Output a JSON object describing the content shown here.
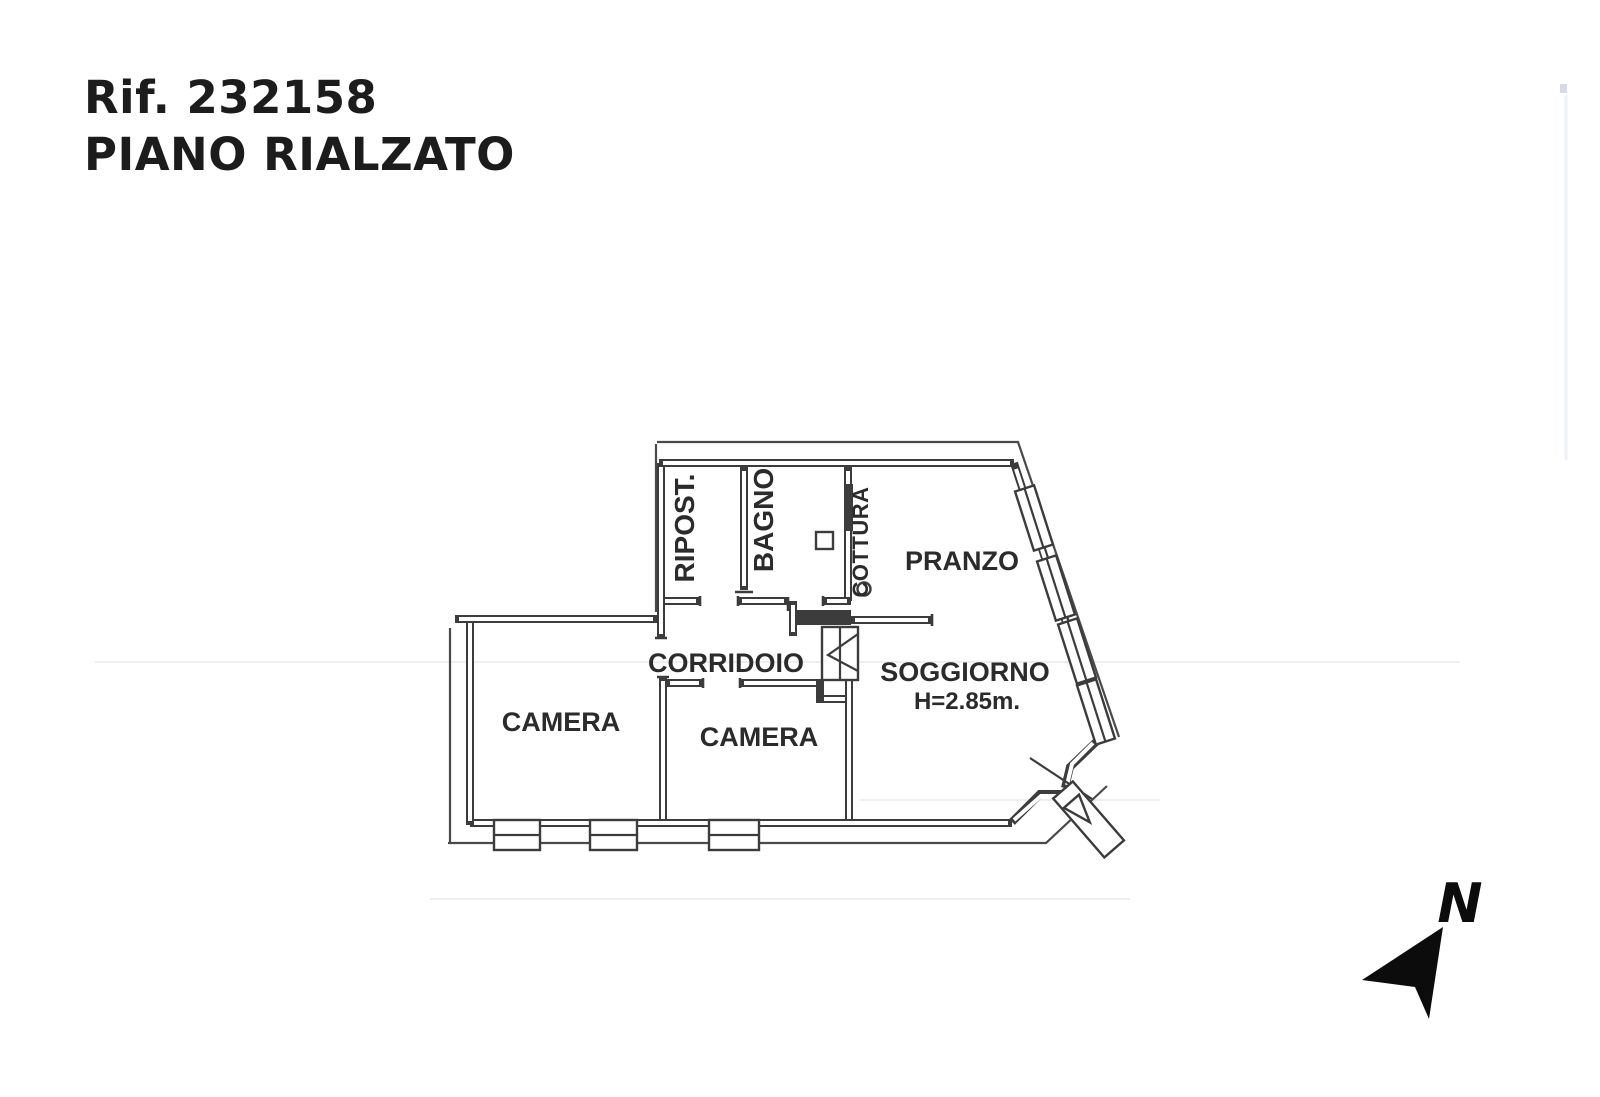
{
  "header": {
    "reference": "Rif. 232158",
    "floor": "PIANO RIALZATO"
  },
  "floorplan": {
    "rooms": {
      "ripost": "RIPOST.",
      "bagno": "BAGNO",
      "cottura": "COTTURA",
      "pranzo": "PRANZO",
      "corridoio": "CORRIDOIO",
      "camera_left": "CAMERA",
      "camera_middle": "CAMERA",
      "soggiorno": "SOGGIORNO",
      "soggiorno_height": "H=2.85m."
    },
    "colors": {
      "wall": "#3c3c3c",
      "label": "#2b2b2b",
      "background": "#ffffff"
    }
  },
  "compass": {
    "north_label": "N"
  }
}
